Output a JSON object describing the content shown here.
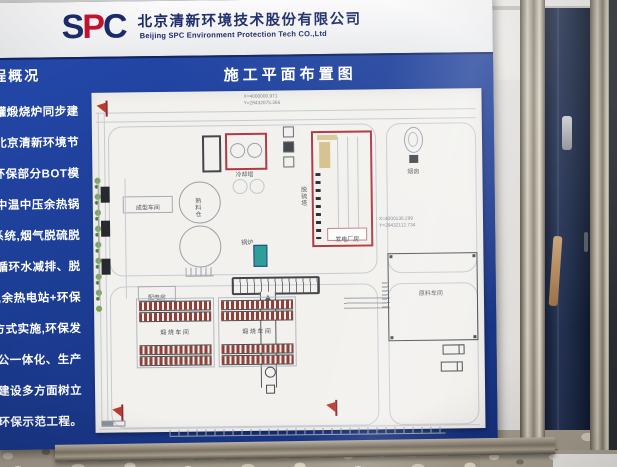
{
  "header": {
    "logo": {
      "s": "S",
      "p": "P",
      "c": "C"
    },
    "company_cn": "北京清新环境技术股份有限公司",
    "company_en": "Beijing SPC Environment Protection Tech CO.,Ltd"
  },
  "banner": {
    "left_title": "程概况",
    "center_title": "施工平面布置图"
  },
  "left_column": {
    "lines": [
      "64罐煅烧炉同步建",
      "由北京清新环境节",
      "C+环保部分BOT模",
      "吨中温中压余热锅",
      "保系统,烟气脱硫脱",
      "步建设循环水减排、脱",
      "投运,余热电站+环保",
      "设的方式实施,环保发",
      "生产办公一体化、生产",
      "程、工程建设多方面树立",
      "电+环保示范工程。"
    ]
  },
  "diagram": {
    "coords_top": [
      "X=4000000.971",
      "Y=29432075.366"
    ],
    "coords_right": [
      "X=4000136.299",
      "Y=29432112.734"
    ],
    "labels": {
      "cooling_tower": "冷却塔",
      "desulfurization_tower": "脱硫塔",
      "boiler": "锅炉",
      "power_house": "发电厂房",
      "clinker_silo": "熟料仓",
      "forming_workshop": "成型车间",
      "power_distribution": "配电房",
      "calcining_workshop": "煅烧车间",
      "raw_material_workshop": "原料车间",
      "chimney": "烟囱"
    }
  },
  "colors": {
    "sign_blue": "#1d3e96",
    "logo_navy": "#1b2a6b",
    "logo_red": "#c41230",
    "highlight_red": "#b23642",
    "boiler_teal": "#2f9e98",
    "unit_brown": "#8f4038"
  }
}
